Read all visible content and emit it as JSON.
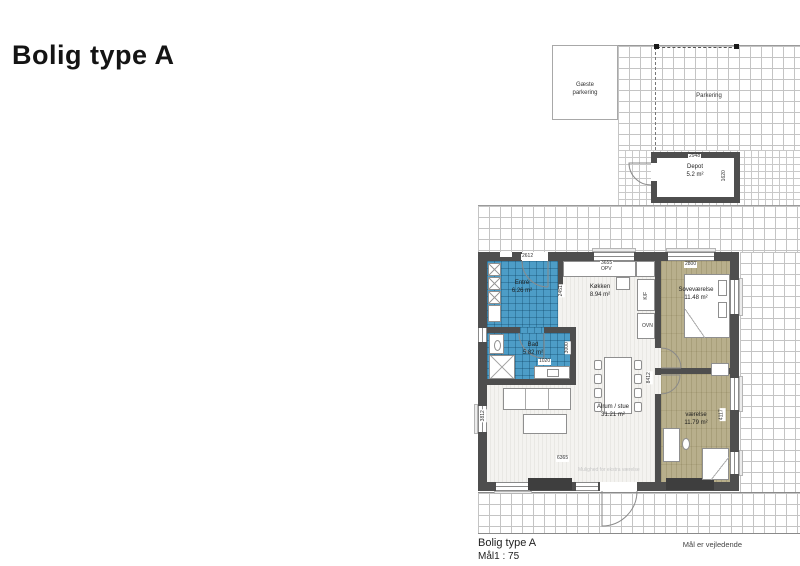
{
  "title": "Bolig type A",
  "colors": {
    "wall": "#4e4e4e",
    "tile_blue": "#4d9dc7",
    "floor_olive": "#b8af8c"
  },
  "site": {
    "guest_parking_line1": "Gæste",
    "guest_parking_line2": "parkering",
    "parking_label": "Parkering"
  },
  "depot": {
    "name": "Depot",
    "area": "5.2 m²"
  },
  "rooms": {
    "entre": {
      "name": "Entré",
      "area": "6.26 m²"
    },
    "bad": {
      "name": "Bad",
      "area": "5.82 m²"
    },
    "koekken": {
      "name": "Køkken",
      "area": "8.94 m²",
      "label_dishwasher": "OPV",
      "label_fridge": "K/F",
      "label_oven": "OVN"
    },
    "sovevaerelse": {
      "name": "Soveværelse",
      "area": "11.48 m²"
    },
    "vaerelse": {
      "name": "værelse",
      "area": "11.79 m²"
    },
    "alrum": {
      "name": "Alrum / stue",
      "area": "31.21 m²",
      "note": "Mulighed for ekstra værelse"
    }
  },
  "dims": {
    "entre_door": "2612",
    "entre_side": "2451",
    "kitchen_top": "3655",
    "bad_vanity": "1020",
    "bad_side": "3000",
    "sove_top": "2800",
    "vaerelse_side": "4117",
    "alrum_width": "6365",
    "alrum_left": "3812",
    "hall": "8412",
    "depot_width": "2948",
    "depot_depth": "1620"
  },
  "footer": {
    "plan_name": "Bolig type A",
    "scale": "Mål1 : 75",
    "disclaimer": "Mål er vejledende"
  }
}
